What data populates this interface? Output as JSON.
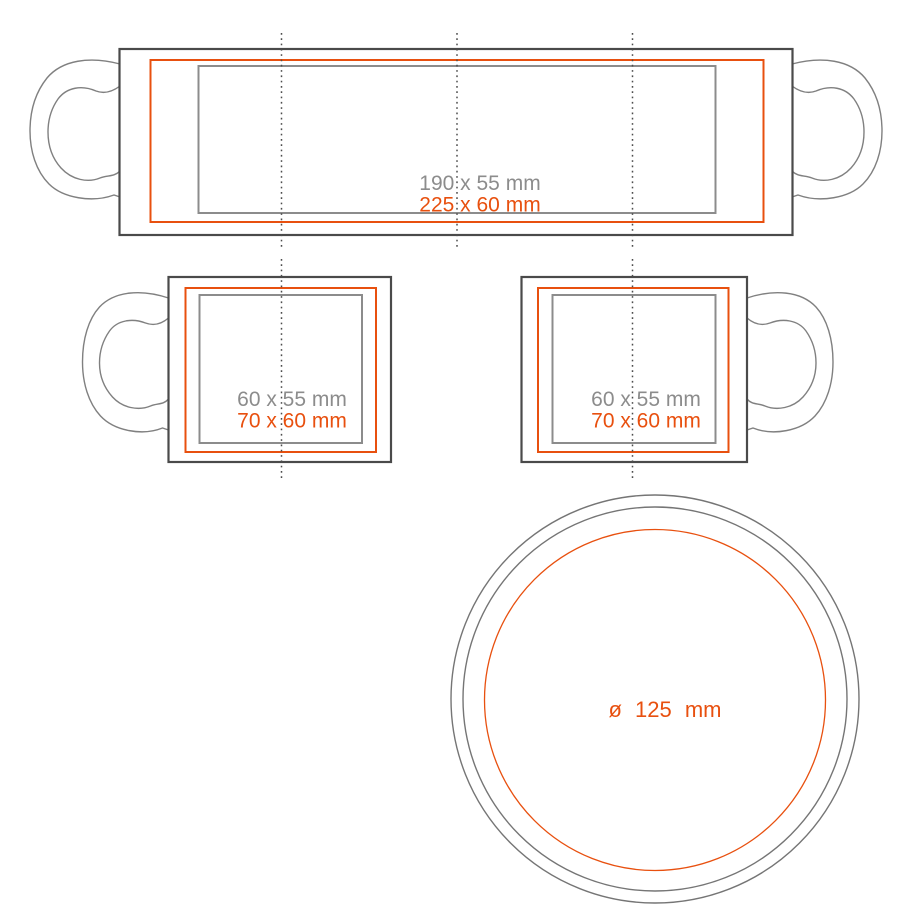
{
  "colors": {
    "accent_orange": "#e8500f",
    "outline_dark": "#4a4a4a",
    "outline_gray": "#8c8c8c",
    "handle_gray": "#808080",
    "label_gray": "#8c8c8c",
    "guide_dark": "#4d4d4d",
    "ring_gray": "#757575"
  },
  "views": {
    "wrap": {
      "print_area_label": "190 x 55 mm",
      "max_area_label": "225 x 60 mm"
    },
    "left_handle": {
      "print_area_label": "60 x 55 mm",
      "max_area_label": "70 x 60 mm"
    },
    "right_handle": {
      "print_area_label": "60 x 55 mm",
      "max_area_label": "70 x 60 mm"
    },
    "bottom": {
      "diameter_label": "ø 125 mm"
    }
  }
}
